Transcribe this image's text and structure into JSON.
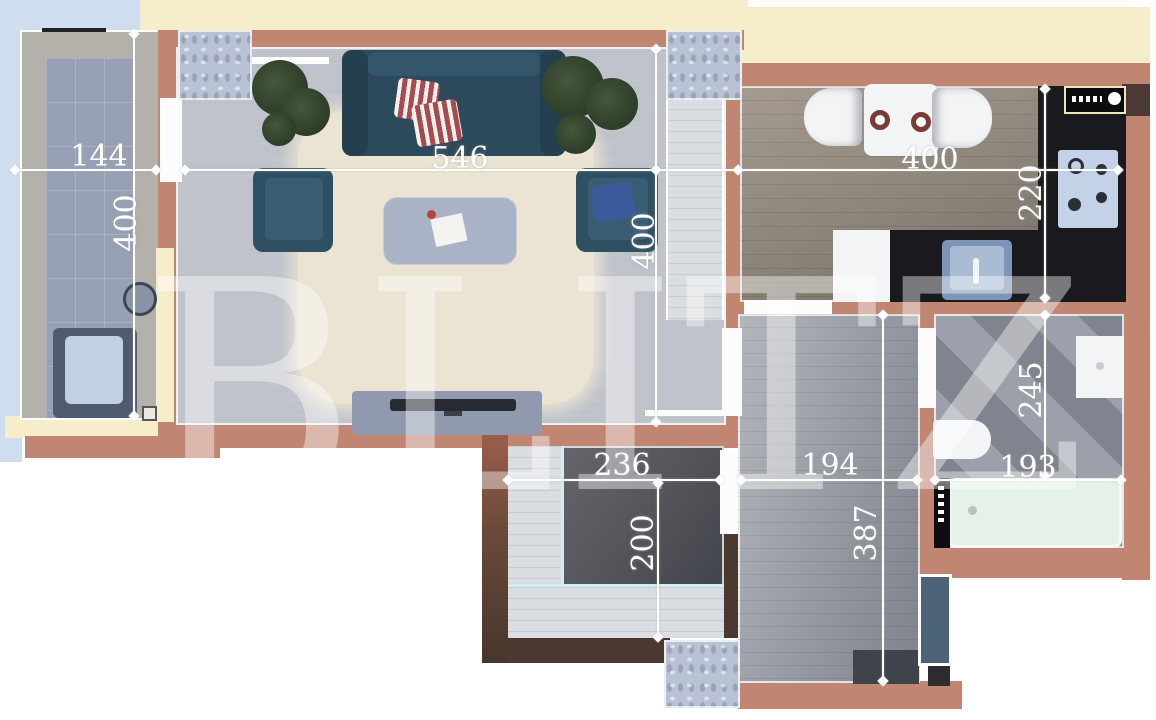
{
  "watermark": "BLITZ",
  "dimensions": {
    "balcony": {
      "width_cm": "144",
      "depth_cm": "400"
    },
    "living_room": {
      "width_cm": "546",
      "depth_cm": "400"
    },
    "kitchen": {
      "width_cm": "400",
      "depth_cm": "220"
    },
    "closet": {
      "width_cm": "236",
      "depth_cm": "200"
    },
    "hallway": {
      "width_cm": "194",
      "depth_cm": "387"
    },
    "bathroom": {
      "depth_cm": "245",
      "width_cm": "193"
    }
  },
  "colors": {
    "wall_terracotta": "#c18672",
    "wall_dark_brown": "#4a392e",
    "exterior_cream": "#f6eecb",
    "balcony_rail_blue": "#cfdeee",
    "sofa_teal": "#2d4a5c",
    "pillow_blue": "#3a5a9c",
    "pillow_stripe_red": "#a84a50",
    "counter_black": "#1a191d",
    "bathtub_mint": "#e6f1e9",
    "entrance_door_blue": "#4c6379",
    "dimension_white": "#ffffff"
  }
}
